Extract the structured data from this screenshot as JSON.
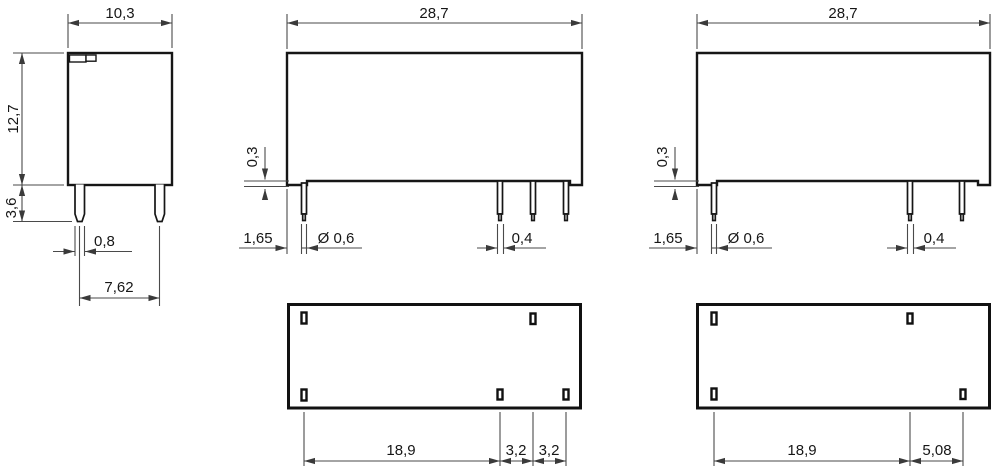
{
  "drawing_title": "relay-dimension-drawing",
  "units_style": "decimal-comma-millimeters",
  "colors": {
    "outline": "#161616",
    "dimension_lines": "#4a4a4a",
    "background": "#ffffff"
  },
  "views": {
    "side": {
      "width": "10,3",
      "height": "12,7",
      "pin_length": "3,6",
      "pin_width": "0,8",
      "pin_pitch": "7,62"
    },
    "front_a": {
      "width": "28,7",
      "standoff": "0,3",
      "pin_inset": "1,65",
      "pin_diameter": "Ø 0,6",
      "pin_thickness": "0,4"
    },
    "front_b": {
      "width": "28,7",
      "standoff": "0,3",
      "pin_inset": "1,65",
      "pin_diameter": "Ø 0,6",
      "pin_thickness": "0,4"
    },
    "bottom_a": {
      "pitch_main": "18,9",
      "pitch_2": "3,2",
      "pitch_3": "3,2"
    },
    "bottom_b": {
      "pitch_main": "18,9",
      "pitch_2": "5,08"
    }
  }
}
